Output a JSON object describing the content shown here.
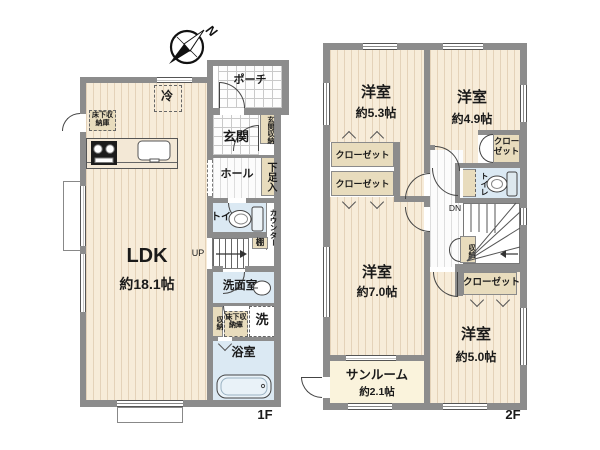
{
  "compass": {
    "north": "N"
  },
  "colors": {
    "wall": "#8c8c8c",
    "wood_floor": "#f7ecd9",
    "wet_floor": "#dbe9f3",
    "closet_fill": "#e8dcbd",
    "sunroom_floor": "#faf3dc",
    "outline": "#444444"
  },
  "floor1": {
    "label": "1F",
    "stairs_direction": "UP",
    "rooms": {
      "ldk": {
        "name": "LDK",
        "size": "約18.1帖"
      },
      "porch": {
        "name": "ポーチ"
      },
      "entrance": {
        "name": "玄関"
      },
      "entrance_storage": {
        "name": "玄関収納"
      },
      "hall": {
        "name": "ホール"
      },
      "shoe_cabinet": {
        "name": "下足入"
      },
      "refrigerator": {
        "name": "冷"
      },
      "underfloor_storage_kitchen": {
        "name": "床下収納庫"
      },
      "toilet": {
        "name": "トイレ"
      },
      "counter": {
        "name": "カウンター"
      },
      "shelf": {
        "name": "棚"
      },
      "washroom": {
        "name": "洗面室"
      },
      "storage": {
        "name": "収納"
      },
      "underfloor_storage_washroom": {
        "name": "床下収納庫"
      },
      "washer": {
        "name": "洗"
      },
      "bathroom": {
        "name": "浴室"
      }
    }
  },
  "floor2": {
    "label": "2F",
    "stairs_direction": "DN",
    "rooms": {
      "bedroom_5_3": {
        "name": "洋室",
        "size": "約5.3帖"
      },
      "bedroom_4_9": {
        "name": "洋室",
        "size": "約4.9帖"
      },
      "bedroom_7_0": {
        "name": "洋室",
        "size": "約7.0帖"
      },
      "bedroom_5_0": {
        "name": "洋室",
        "size": "約5.0帖"
      },
      "sunroom": {
        "name": "サンルーム",
        "size": "約2.1帖"
      },
      "closet_upper_left": {
        "name": "クローゼット"
      },
      "closet_lower_left": {
        "name": "クローゼット"
      },
      "closet_ne": {
        "name": "クローゼット"
      },
      "closet_se": {
        "name": "クローゼット"
      },
      "toilet": {
        "name": "トイレ"
      },
      "storage": {
        "name": "収納"
      }
    }
  }
}
